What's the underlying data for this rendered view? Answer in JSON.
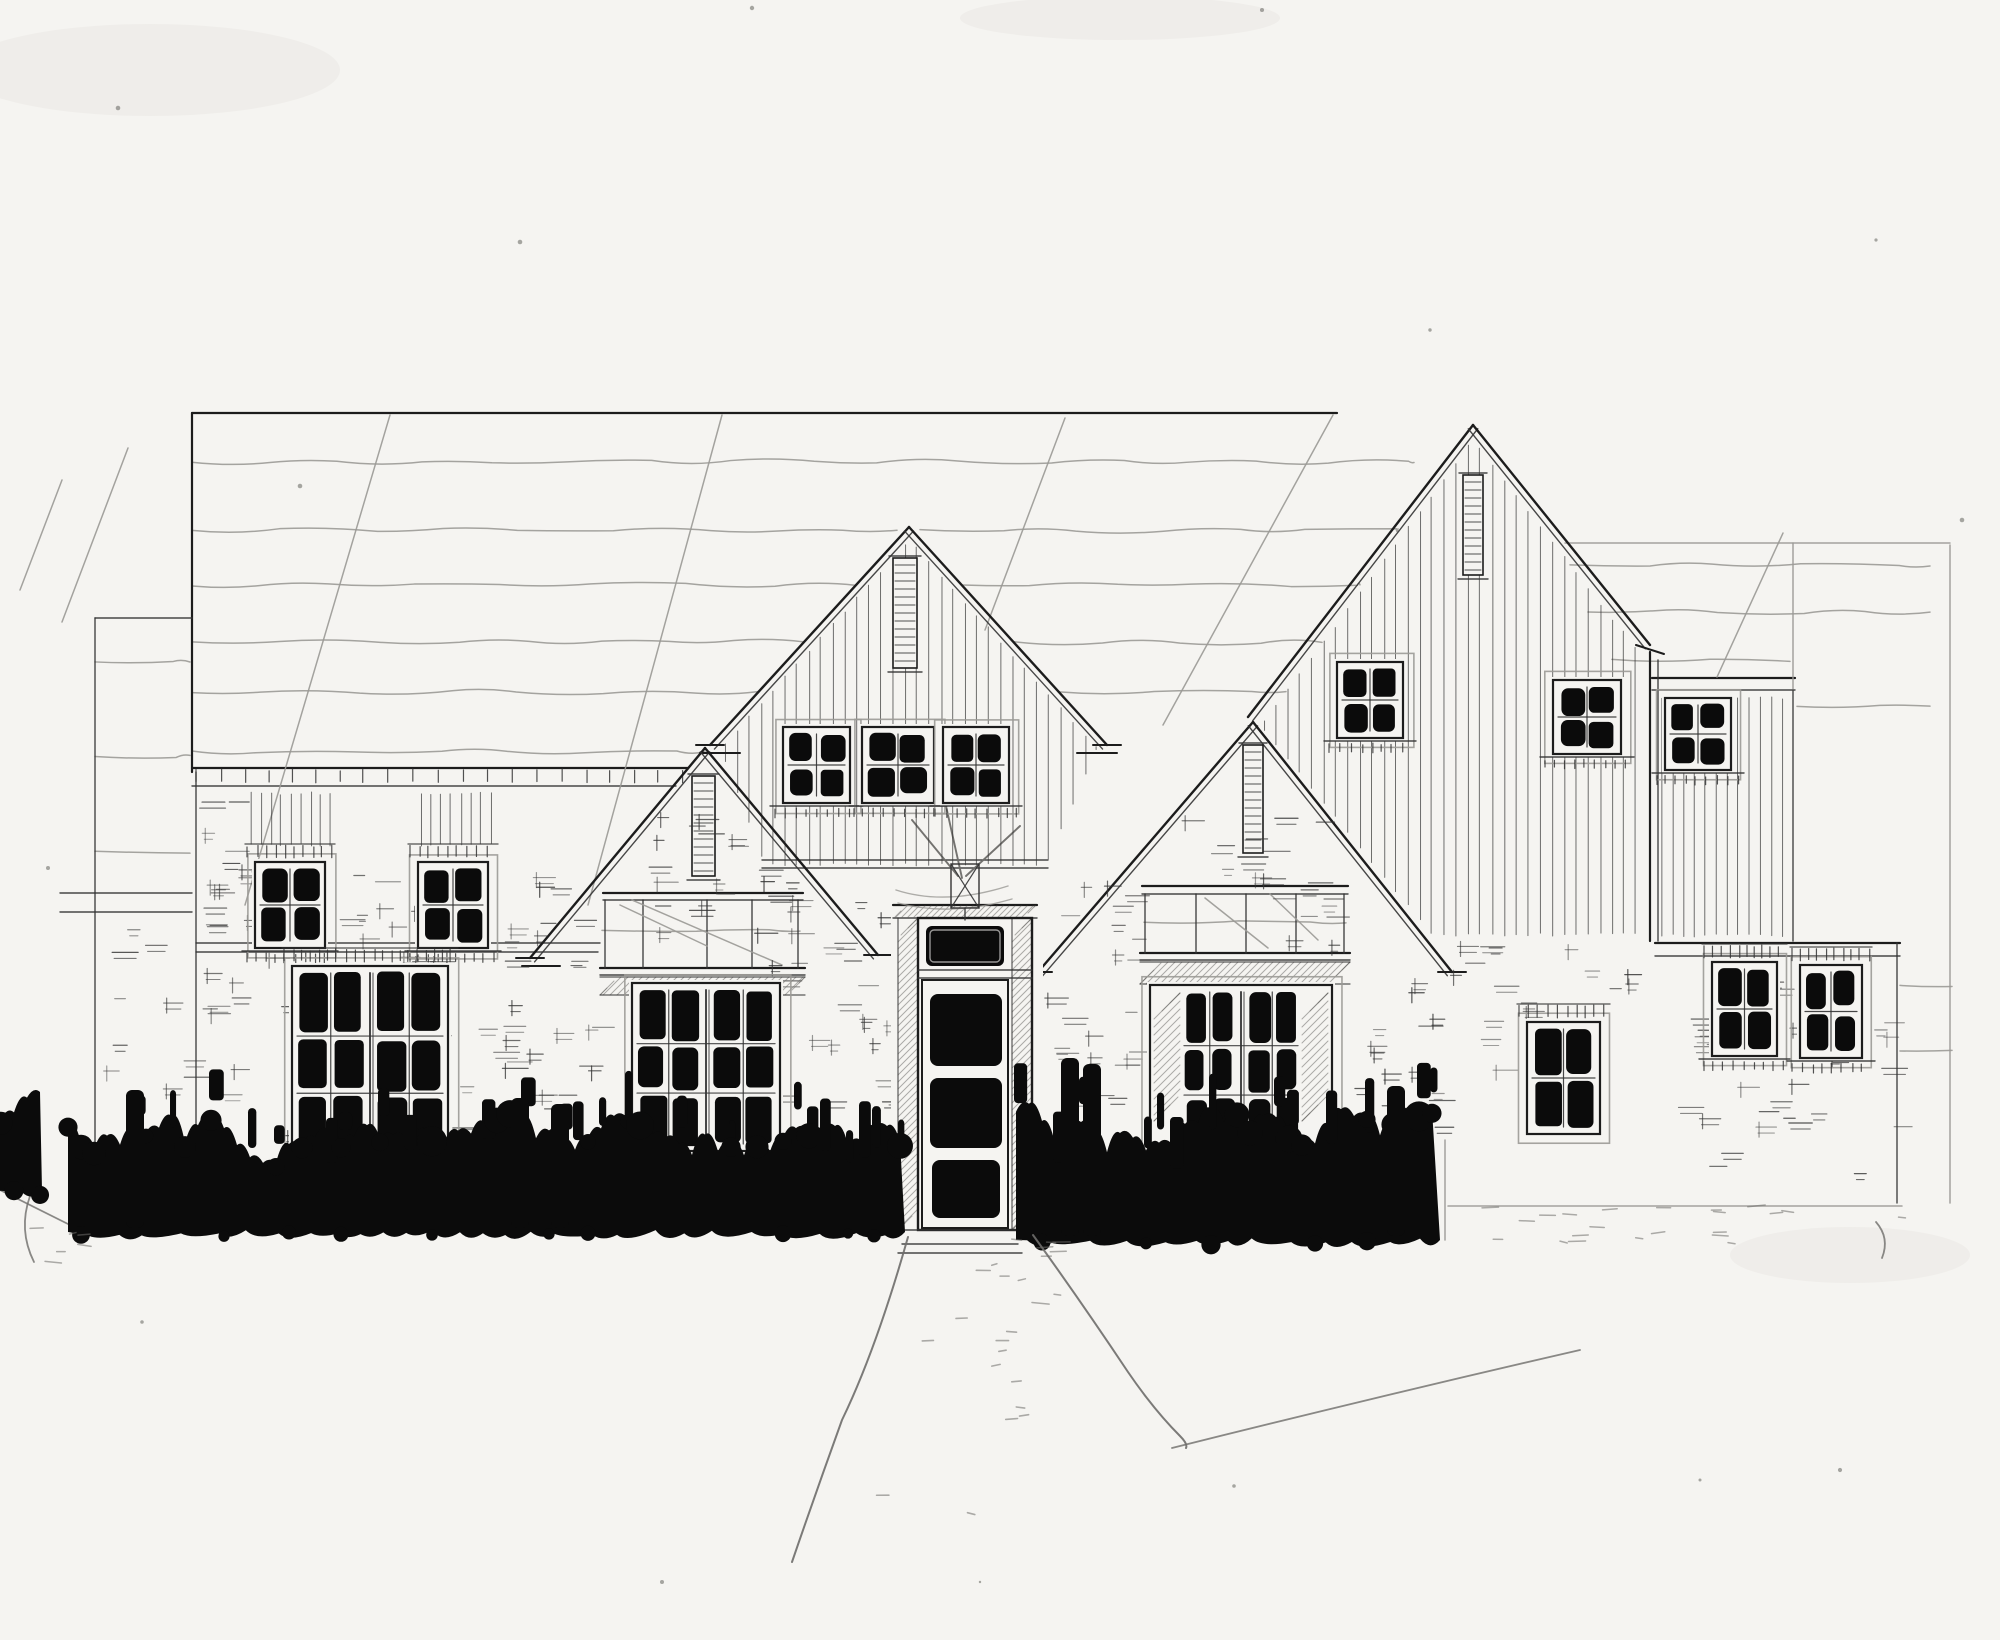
{
  "meta": {
    "kind": "hand-drawn architectural front elevation sketch",
    "title": ""
  },
  "colors": {
    "paper": "#f5f4f1",
    "ink": "#0b0b0b",
    "pen": "#1c1c1c",
    "thin": "#343434",
    "pencil": "#9b9a96",
    "pencil_dark": "#6e6d6a",
    "siding": "#3b3b3b",
    "speck": "#555550"
  },
  "canvas": {
    "w": 2000,
    "h": 1640
  },
  "pen_lines": [
    [
      192,
      413,
      1337,
      413,
      "p"
    ],
    [
      192,
      413,
      192,
      772,
      "p"
    ],
    [
      196,
      772,
      196,
      1152,
      "t"
    ],
    [
      95,
      618,
      192,
      618,
      "t"
    ],
    [
      95,
      618,
      95,
      1158,
      "t"
    ],
    [
      60,
      893,
      192,
      893,
      "t"
    ],
    [
      60,
      912,
      192,
      912,
      "t"
    ],
    [
      192,
      768,
      688,
      768,
      "p"
    ],
    [
      192,
      786,
      676,
      786,
      "t"
    ],
    [
      196,
      943,
      600,
      943,
      "t"
    ],
    [
      196,
      952,
      598,
      952,
      "t"
    ],
    [
      762,
      860,
      1048,
      860,
      "t"
    ],
    [
      762,
      868,
      1048,
      868,
      "t"
    ],
    [
      1652,
      678,
      1795,
      678,
      "p"
    ],
    [
      1652,
      690,
      1795,
      690,
      "t"
    ],
    [
      1650,
      652,
      1650,
      941,
      "p"
    ],
    [
      1658,
      660,
      1658,
      941,
      "t"
    ],
    [
      1793,
      543,
      1793,
      690,
      "c"
    ],
    [
      1793,
      690,
      1793,
      941,
      "t"
    ],
    [
      1655,
      943,
      1900,
      943,
      "p"
    ],
    [
      1655,
      956,
      1900,
      956,
      "t"
    ],
    [
      1897,
      943,
      1897,
      1203,
      "t"
    ],
    [
      1950,
      545,
      1950,
      1203,
      "c"
    ],
    [
      1565,
      543,
      1950,
      543,
      "c"
    ],
    [
      1783,
      533,
      1717,
      677,
      "c"
    ],
    [
      1448,
      1206,
      1902,
      1206,
      "c"
    ],
    [
      1445,
      1140,
      1445,
      1240,
      "c"
    ],
    [
      390,
      415,
      245,
      905,
      "c"
    ],
    [
      722,
      415,
      588,
      905,
      "c"
    ],
    [
      1065,
      418,
      985,
      630,
      "c"
    ],
    [
      1333,
      415,
      1163,
      725,
      "c"
    ],
    [
      128,
      448,
      62,
      622,
      "c"
    ],
    [
      62,
      480,
      20,
      590,
      "c"
    ],
    [
      603,
      893,
      803,
      893,
      "p"
    ],
    [
      603,
      900,
      803,
      900,
      "t"
    ],
    [
      600,
      968,
      805,
      968,
      "p"
    ],
    [
      600,
      975,
      805,
      975,
      "t"
    ],
    [
      605,
      900,
      605,
      968,
      "t"
    ],
    [
      643,
      900,
      643,
      968,
      "t"
    ],
    [
      707,
      900,
      707,
      968,
      "t"
    ],
    [
      752,
      900,
      752,
      968,
      "t"
    ],
    [
      798,
      900,
      798,
      968,
      "t"
    ],
    [
      1142,
      886,
      1348,
      886,
      "p"
    ],
    [
      1142,
      894,
      1348,
      894,
      "t"
    ],
    [
      1140,
      953,
      1350,
      953,
      "p"
    ],
    [
      1140,
      960,
      1350,
      960,
      "t"
    ],
    [
      1145,
      894,
      1145,
      953,
      "t"
    ],
    [
      1196,
      894,
      1196,
      953,
      "t"
    ],
    [
      1246,
      894,
      1246,
      953,
      "t"
    ],
    [
      1296,
      894,
      1296,
      953,
      "t"
    ],
    [
      1344,
      894,
      1344,
      953,
      "t"
    ],
    [
      902,
      1244,
      1018,
      1244,
      "t"
    ],
    [
      898,
      1253,
      1022,
      1253,
      "t"
    ],
    [
      958,
      876,
      912,
      820,
      "d"
    ],
    [
      966,
      876,
      1020,
      826,
      "d"
    ],
    [
      962,
      878,
      946,
      806,
      "d"
    ],
    [
      620,
      905,
      707,
      946,
      "c"
    ],
    [
      632,
      900,
      782,
      965,
      "c"
    ],
    [
      1205,
      898,
      1268,
      948,
      "c"
    ],
    [
      1270,
      894,
      1318,
      940,
      "c"
    ]
  ],
  "waves": [
    [
      192,
      1414,
      462,
      3
    ],
    [
      192,
      897,
      530,
      3
    ],
    [
      920,
      1398,
      530,
      3
    ],
    [
      192,
      856,
      585,
      3
    ],
    [
      962,
      1360,
      585,
      3
    ],
    [
      192,
      804,
      642,
      3
    ],
    [
      1014,
      1322,
      642,
      3
    ],
    [
      192,
      759,
      692,
      3
    ],
    [
      1059,
      1286,
      692,
      3
    ],
    [
      192,
      705,
      752,
      3
    ],
    [
      95,
      190,
      662,
      2
    ],
    [
      95,
      190,
      757,
      2
    ],
    [
      95,
      190,
      852,
      2
    ],
    [
      1570,
      1930,
      565,
      3
    ],
    [
      1588,
      1930,
      612,
      3
    ],
    [
      1612,
      1790,
      660,
      2
    ],
    [
      1797,
      1930,
      706,
      2
    ],
    [
      1900,
      1952,
      985,
      2
    ],
    [
      1900,
      1952,
      1050,
      2
    ],
    [
      602,
      800,
      930,
      2
    ],
    [
      1144,
      1346,
      922,
      2
    ]
  ],
  "curves": [
    "M0,1190 Q48,1214 92,1236",
    "M30,1196 Q18,1230 34,1262",
    "M1172,1448 Q1380,1396 1580,1350",
    "M1876,1222 q14,16 6,36"
  ],
  "gables": [
    {
      "name": "central-gable",
      "peak": [
        909,
        527
      ],
      "ends": [
        [
          710,
          745
        ],
        [
          1107,
          745
        ]
      ],
      "returns": [
        [
          696,
          745,
          724,
          745
        ],
        [
          700,
          753,
          740,
          753
        ],
        [
          1093,
          745,
          1121,
          745
        ],
        [
          1077,
          753,
          1117,
          753
        ]
      ]
    },
    {
      "name": "left-mid-gable",
      "peak": [
        705,
        748
      ],
      "ends": [
        [
          530,
          958
        ],
        [
          878,
          955
        ]
      ],
      "returns": [
        [
          516,
          958,
          544,
          958
        ],
        [
          522,
          966,
          560,
          966
        ],
        [
          864,
          955,
          892,
          955
        ]
      ]
    },
    {
      "name": "right-mid-gable",
      "peak": [
        1253,
        722
      ],
      "ends": [
        [
          1038,
          972
        ],
        [
          1452,
          972
        ]
      ],
      "returns": [
        [
          1024,
          972,
          1052,
          972
        ],
        [
          1438,
          972,
          1466,
          972
        ]
      ]
    },
    {
      "name": "right-gable",
      "peak": [
        1473,
        425
      ],
      "ends": [
        [
          1248,
          717
        ],
        [
          1650,
          645
        ]
      ],
      "returns": [
        [
          1636,
          645,
          1664,
          654
        ]
      ]
    }
  ],
  "vents": [
    [
      893,
      558,
      24,
      110
    ],
    [
      692,
      776,
      23,
      100
    ],
    [
      1243,
      745,
      20,
      108
    ],
    [
      1463,
      475,
      20,
      100
    ]
  ],
  "siding_regions": [
    {
      "name": "central-gable-siding",
      "poly": [
        [
          909,
          537
        ],
        [
          719,
          747
        ],
        [
          765,
          868
        ],
        [
          1046,
          868
        ],
        [
          1099,
          747
        ]
      ],
      "sp": 12
    },
    {
      "name": "right-gable-siding",
      "poly": [
        [
          1473,
          437
        ],
        [
          1258,
          727
        ],
        [
          1432,
          938
        ],
        [
          1646,
          938
        ],
        [
          1646,
          658
        ]
      ],
      "sp": 12
    },
    {
      "name": "wing-siding",
      "poly": [
        [
          1656,
          694
        ],
        [
          1791,
          694
        ],
        [
          1791,
          939
        ],
        [
          1656,
          939
        ]
      ],
      "sp": 11
    },
    {
      "name": "left-band-siding-1",
      "poly": [
        [
          246,
          790
        ],
        [
          334,
          790
        ],
        [
          334,
          848
        ],
        [
          246,
          848
        ]
      ],
      "sp": 10
    },
    {
      "name": "left-band-siding-2",
      "poly": [
        [
          416,
          790
        ],
        [
          497,
          790
        ],
        [
          497,
          848
        ],
        [
          416,
          848
        ]
      ],
      "sp": 10
    }
  ],
  "hatch_strips": [
    [
      600,
      977,
      205,
      18
    ],
    [
      1140,
      962,
      210,
      22
    ]
  ],
  "windows": [
    {
      "id": "left-small-window-1",
      "x": 255,
      "y": 862,
      "w": 70,
      "h": 86,
      "cols": 2,
      "rows": 2,
      "header": true,
      "sill": true
    },
    {
      "id": "left-small-window-2",
      "x": 418,
      "y": 862,
      "w": 70,
      "h": 86,
      "cols": 2,
      "rows": 2,
      "header": true,
      "sill": true
    },
    {
      "id": "left-large-window",
      "x": 292,
      "y": 966,
      "w": 156,
      "h": 194,
      "cols": 4,
      "rows": 3,
      "large": true,
      "header": true
    },
    {
      "id": "left-bay-window",
      "x": 632,
      "y": 983,
      "w": 148,
      "h": 168,
      "cols": 4,
      "rows": 3,
      "large": true
    },
    {
      "id": "center-gable-window-1",
      "x": 783,
      "y": 727,
      "w": 67,
      "h": 76,
      "cols": 2,
      "rows": 2,
      "sill": true
    },
    {
      "id": "center-gable-window-2",
      "x": 862,
      "y": 727,
      "w": 72,
      "h": 76,
      "cols": 2,
      "rows": 2,
      "sill": true
    },
    {
      "id": "center-gable-window-3",
      "x": 943,
      "y": 727,
      "w": 66,
      "h": 76,
      "cols": 2,
      "rows": 2,
      "sill": true
    },
    {
      "id": "right-gable-window-1",
      "x": 1337,
      "y": 662,
      "w": 66,
      "h": 76,
      "cols": 2,
      "rows": 2,
      "sill": true
    },
    {
      "id": "right-gable-window-2",
      "x": 1553,
      "y": 680,
      "w": 68,
      "h": 74,
      "cols": 2,
      "rows": 2,
      "sill": true
    },
    {
      "id": "wing-window",
      "x": 1665,
      "y": 698,
      "w": 66,
      "h": 72,
      "cols": 2,
      "rows": 2,
      "sill": true
    },
    {
      "id": "right-bay-window",
      "x": 1150,
      "y": 985,
      "w": 182,
      "h": 168,
      "cols": 4,
      "rows": 3,
      "large": true,
      "shade": true
    },
    {
      "id": "entry-side-window",
      "x": 1527,
      "y": 1022,
      "w": 73,
      "h": 112,
      "cols": 2,
      "rows": 2,
      "header": true
    },
    {
      "id": "garage-window-1",
      "x": 1712,
      "y": 962,
      "w": 65,
      "h": 94,
      "cols": 2,
      "rows": 2,
      "header": true,
      "sill": true
    },
    {
      "id": "garage-window-2",
      "x": 1800,
      "y": 965,
      "w": 62,
      "h": 93,
      "cols": 2,
      "rows": 2,
      "header": true,
      "sill": true
    }
  ],
  "door": {
    "bg": [
      891,
      898,
      152,
      334
    ],
    "head": [
      [
        893,
        905,
        1037,
        905
      ],
      [
        893,
        918,
        1037,
        918
      ]
    ],
    "head_hatch": [
      895,
      906,
      140,
      11
    ],
    "jambs": [
      [
        898,
        918,
        20,
        312
      ],
      [
        1012,
        918,
        20,
        312
      ]
    ],
    "frame": [
      918,
      918,
      114,
      312
    ],
    "transom": [
      926,
      926,
      78,
      40
    ],
    "bar": [
      [
        918,
        970,
        1032,
        970
      ],
      [
        918,
        978,
        1032,
        978
      ]
    ],
    "leaf": [
      922,
      980,
      86,
      248
    ],
    "panels": [
      [
        930,
        994,
        72,
        72
      ],
      [
        930,
        1078,
        72,
        70
      ],
      [
        932,
        1160,
        68,
        58
      ]
    ],
    "threshold": [
      905,
      1230,
      1025,
      1230
    ],
    "swags": [
      "M896,890 Q945,906 1008,886",
      "M898,903 Q950,917 1012,899"
    ],
    "fixture": [
      951,
      864,
      28,
      44
    ]
  },
  "brick_regions": [
    [
      196,
      795,
      58,
      150,
      12
    ],
    [
      200,
      952,
      350,
      190,
      42
    ],
    [
      498,
      905,
      100,
      230,
      18
    ],
    [
      640,
      810,
      150,
      125,
      18
    ],
    [
      766,
      872,
      128,
      240,
      26
    ],
    [
      1034,
      872,
      106,
      240,
      22
    ],
    [
      1180,
      808,
      150,
      140,
      20
    ],
    [
      1352,
      978,
      172,
      150,
      20
    ],
    [
      1430,
      940,
      218,
      58,
      10
    ],
    [
      1662,
      960,
      233,
      235,
      34
    ],
    [
      100,
      925,
      86,
      190,
      10
    ],
    [
      340,
      852,
      72,
      92,
      8
    ],
    [
      198,
      852,
      50,
      92,
      6
    ],
    [
      494,
      852,
      60,
      92,
      6
    ]
  ],
  "tick_rows": [
    [
      196,
      769,
      490,
      14
    ]
  ],
  "shrubs": [
    {
      "x1": 68,
      "x2": 905,
      "base": 1228,
      "hmin": 52,
      "hmax": 128,
      "seed": 7,
      "spikes": [
        [
          135,
          1090
        ],
        [
          520,
          1098
        ],
        [
          560,
          1104
        ]
      ]
    },
    {
      "x1": 1016,
      "x2": 1440,
      "base": 1236,
      "hmin": 58,
      "hmax": 148,
      "seed": 11,
      "spikes": [
        [
          1070,
          1058
        ],
        [
          1092,
          1064
        ],
        [
          1396,
          1086
        ]
      ]
    },
    {
      "x1": -12,
      "x2": 42,
      "base": 1186,
      "hmin": 40,
      "hmax": 118,
      "seed": 3,
      "spikes": []
    }
  ],
  "ground": {
    "walkway": {
      "left": "M908,1237 Q876,1350 842,1420 Q816,1492 792,1562",
      "right": "M1033,1235 Q1080,1300 1128,1372 Q1154,1410 1180,1436 q8,8 6,12",
      "dots": 14
    },
    "pebbles": [
      [
        1452,
        1205,
        470,
        45,
        22
      ],
      [
        995,
        1238,
        60,
        66,
        10
      ],
      [
        15,
        1228,
        80,
        40,
        6
      ]
    ]
  },
  "smudges": [
    [
      150,
      70,
      190,
      46
    ],
    [
      1120,
      18,
      160,
      22
    ],
    [
      1850,
      1255,
      120,
      28
    ]
  ],
  "specks": [
    [
      1262,
      10
    ],
    [
      752,
      8
    ],
    [
      118,
      108
    ],
    [
      300,
      486
    ],
    [
      1876,
      240
    ],
    [
      1430,
      330
    ],
    [
      48,
      868
    ],
    [
      1962,
      520
    ],
    [
      662,
      1582
    ],
    [
      1234,
      1486
    ],
    [
      142,
      1322
    ],
    [
      1840,
      1470
    ],
    [
      520,
      242
    ],
    [
      980,
      1582
    ],
    [
      1700,
      1480
    ]
  ]
}
